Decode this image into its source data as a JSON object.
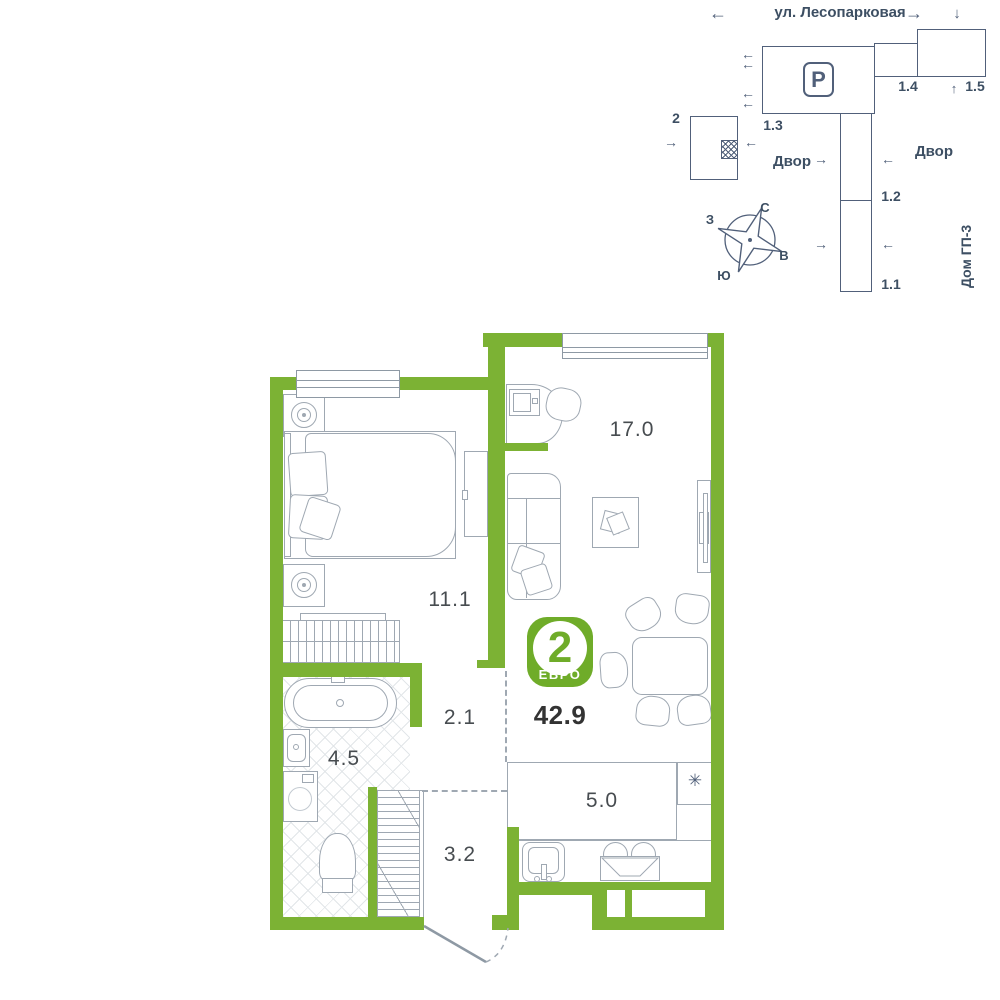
{
  "site_plan": {
    "street": "ул. Лесопарковая",
    "courtyard_left": "Двор",
    "courtyard_right": "Двор",
    "house_label": "Дом ГП-3",
    "parking_icon": "P",
    "buildings": {
      "b2": "2",
      "b13": "1.3",
      "b14": "1.4",
      "b15": "1.5",
      "b12": "1.2",
      "b11": "1.1"
    },
    "compass": {
      "north": "С",
      "south": "Ю",
      "west": "З",
      "east": "В"
    }
  },
  "floor_plan": {
    "rooms": {
      "living": "17.0",
      "bedroom": "11.1",
      "hall": "2.1",
      "bathroom": "4.5",
      "entry": "3.2",
      "kitchen": "5.0"
    },
    "badge": {
      "rooms_count": "2",
      "type_label": "ЕВРО",
      "total_area": "42.9"
    },
    "fridge_symbol": "✳"
  },
  "icons": {
    "arrow_left": "←",
    "arrow_right": "→",
    "arrow_up": "↑",
    "arrow_down": "↓"
  },
  "colors": {
    "wall_green": "#7CB234",
    "badge_green": "#6FAC29",
    "line_slate": "#51607A",
    "text_dark": "#3D4F63",
    "furniture_gray": "#9FA8B2"
  }
}
